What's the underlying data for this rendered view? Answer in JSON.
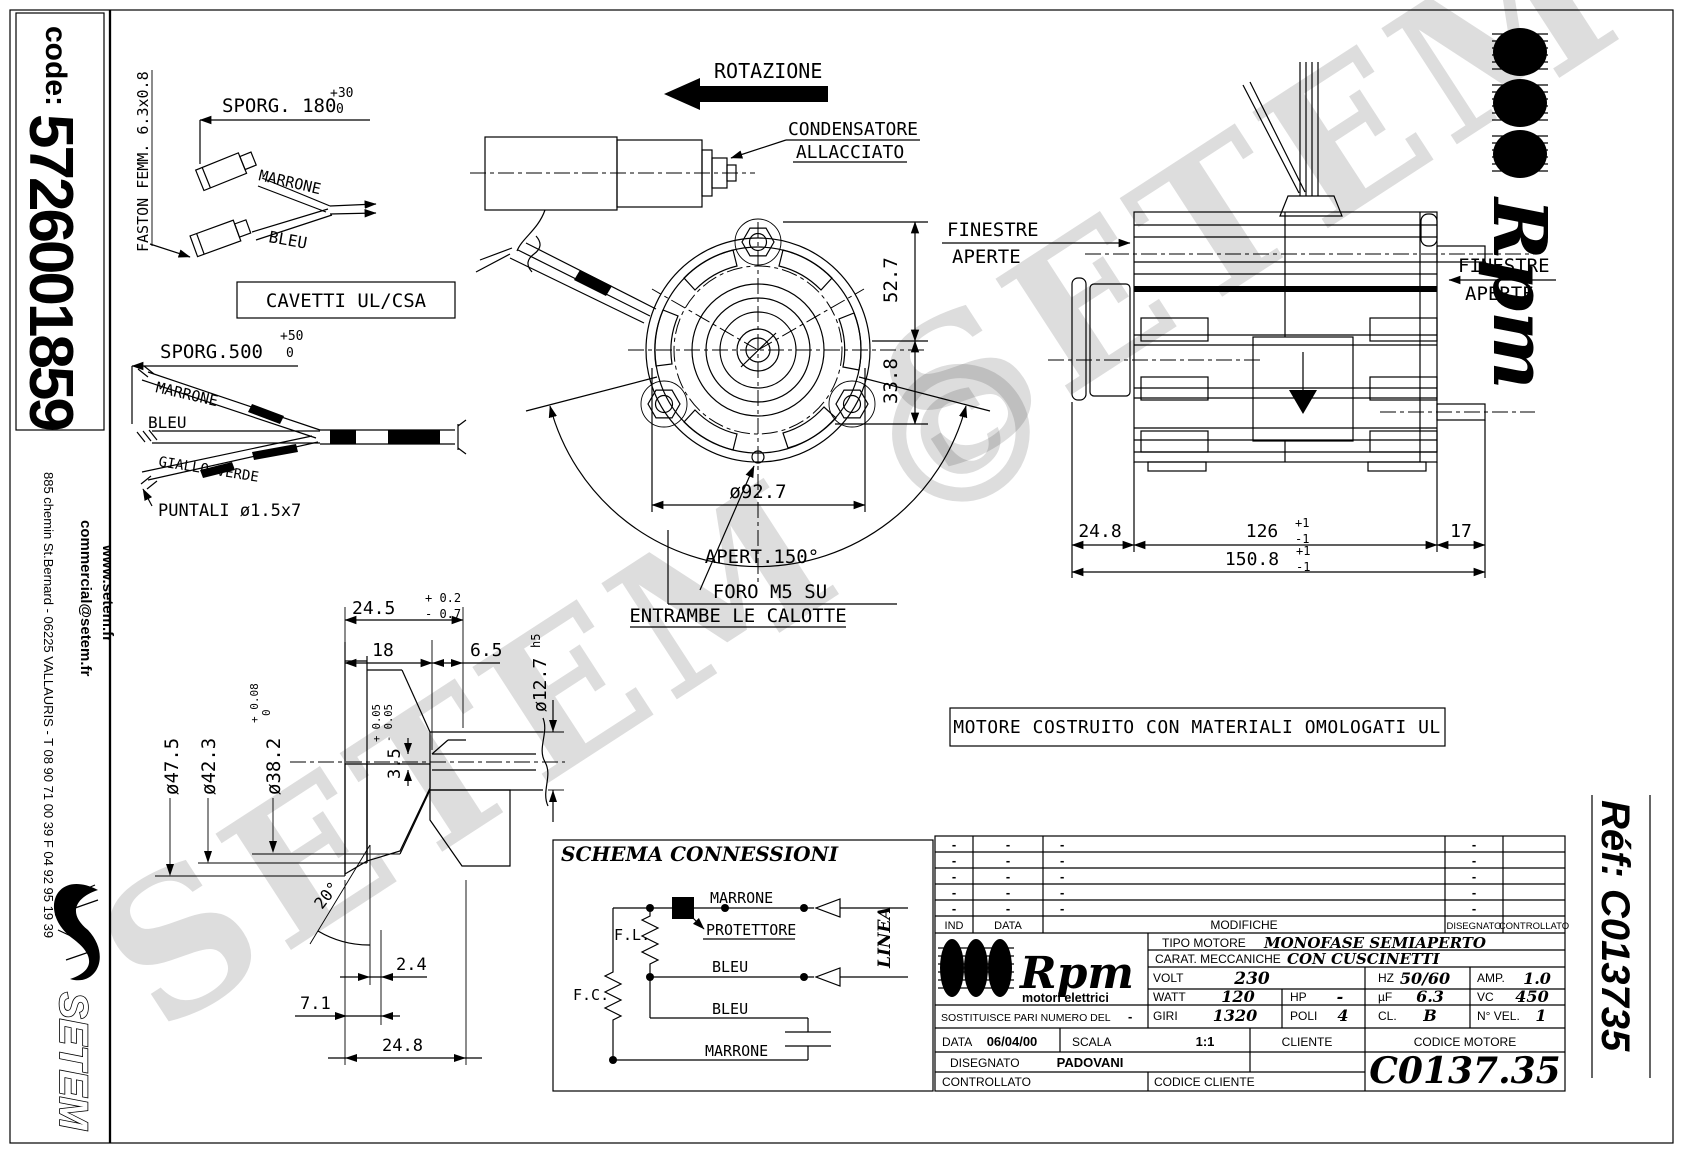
{
  "sheet": {
    "code_label": "code:",
    "code_value": "5726001859",
    "address": "885 chemin St.Bernard  -  06225 VALLAURIS  -  T 08 90 71 00 39   F 04 92 95 19 39",
    "email": "commercial@setem.fr",
    "website": "www.setem.fr",
    "setem_logo": "SETEM",
    "watermark": "SETEM ©"
  },
  "cavetti": {
    "box_label": "CAVETTI UL/CSA",
    "sporg180": "SPORG. 180",
    "sporg180_tol_plus": "+30",
    "sporg180_tol_minus": "0",
    "faston": "FASTON FEMM. 6.3x0.8",
    "marrone": "MARRONE",
    "bleu": "BLEU",
    "sporg500": "SPORG.500",
    "sporg500_tol_plus": "+50",
    "sporg500_tol_minus": "0",
    "marrone2": "MARRONE",
    "bleu2": "BLEU",
    "giallo_verde": "GIALLO-VERDE",
    "puntali": "PUNTALI ø1.5x7"
  },
  "front_view": {
    "rotazione": "ROTAZIONE",
    "condensatore1": "CONDENSATORE",
    "condensatore2": "ALLACCIATO",
    "dim_52_7": "52.7",
    "dim_33_8": "33.8",
    "dim_92_7": "ø92.7",
    "apert": "APERT.150°",
    "foro1": "FORO M5 SU",
    "foro2": "ENTRAMBE LE CALOTTE"
  },
  "side_view": {
    "finestre": "FINESTRE",
    "aperte": "APERTE",
    "dim_24_8": "24.8",
    "dim_126": "126",
    "dim_17": "17",
    "dim_150_8": "150.8",
    "tol_plus_1": "+1",
    "tol_minus_1": "-1"
  },
  "shaft": {
    "dim_24_5": "24.5",
    "tol_24_5_plus": "+ 0.2",
    "tol_24_5_minus": "- 0.7",
    "dim_18": "18",
    "dim_6_5": "6.5",
    "dia_12_7": "ø12.7",
    "h5": "h5",
    "dia_47_5": "ø47.5",
    "dia_42_3": "ø42.3",
    "dia_38_2": "ø38.2",
    "tol_38_plus": "+ 0.08",
    "tol_38_minus": "0",
    "dim_3_5": "3.5",
    "tol_3_5_plus": "+ 0.05",
    "tol_3_5_minus": "- 0.05",
    "angle_20": "20°",
    "dim_2_4": "2.4",
    "dim_7_1": "7.1",
    "dim_24_8": "24.8"
  },
  "ul_note": "MOTORE COSTRUITO CON MATERIALI OMOLOGATI UL",
  "schema": {
    "title": "SCHEMA CONNESSIONI",
    "marrone_top": "MARRONE",
    "protettore": "PROTETTORE",
    "fl": "F.L.",
    "fc": "F.C.",
    "bleu_mid": "BLEU",
    "bleu_low": "BLEU",
    "marrone_bottom": "MARRONE",
    "linea": "LINEA"
  },
  "title_block": {
    "dash": "-",
    "headers": {
      "ind": "IND",
      "data": "DATA",
      "modifiche": "MODIFICHE",
      "disegnato": "DISEGNATO",
      "controllato": "CONTROLLATO"
    },
    "brand": "Rpm",
    "tagline": "motori elettrici",
    "tipo_label": "TIPO MOTORE",
    "tipo_value": "MONOFASE SEMIAPERTO",
    "carat_label": "CARAT. MECCANICHE",
    "carat_value": "CON CUSCINETTI",
    "volt_label": "VOLT",
    "volt_value": "230",
    "hz_label": "HZ",
    "hz_value": "50/60",
    "amp_label": "AMP.",
    "amp_value": "1.0",
    "watt_label": "WATT",
    "watt_value": "120",
    "hp_label": "HP",
    "hp_value": "-",
    "uf_label": "µF",
    "uf_value": "6.3",
    "vc_label": "VC",
    "vc_value": "450",
    "giri_label": "GIRI",
    "giri_value": "1320",
    "poli_label": "POLI",
    "poli_value": "4",
    "cl_label": "CL.",
    "cl_value": "B",
    "nvel_label": "N° VEL.",
    "nvel_value": "1",
    "sostituisce_label": "SOSTITUISCE PARI NUMERO DEL",
    "data_label": "DATA",
    "data_value": "06/04/00",
    "scala_label": "SCALA",
    "scala_value": "1:1",
    "cliente_label": "CLIENTE",
    "codice_motore_label": "CODICE MOTORE",
    "disegnato_label": "DISEGNATO",
    "disegnato_value": "PADOVANI",
    "controllato_label": "CONTROLLATO",
    "codice_cliente_label": "CODICE CLIENTE",
    "codice_motore_value": "C0137.35"
  },
  "right_strip": {
    "brand": "Rpm",
    "ref": "Réf:  C013735"
  }
}
